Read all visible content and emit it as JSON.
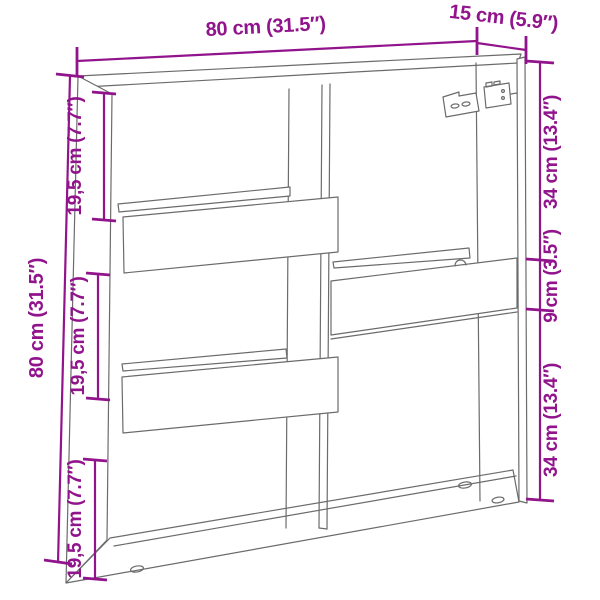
{
  "dimensions": {
    "top_width": "80 cm (31.5″)",
    "top_depth": "15 cm (5.9″)",
    "left_height": "80 cm (31.5″)",
    "left_sections": [
      "19,5 cm (7.7″)",
      "19,5 cm (7.7″)",
      "19,5 cm (7.7″)"
    ],
    "right_sections": [
      "34 cm (13.4″)",
      "9 cm (3.5″)",
      "34 cm (13.4″)"
    ]
  },
  "colors": {
    "dimension_accent": "#91148C",
    "drawing_line": "#6B6B6B",
    "background": "#FFFFFF"
  }
}
